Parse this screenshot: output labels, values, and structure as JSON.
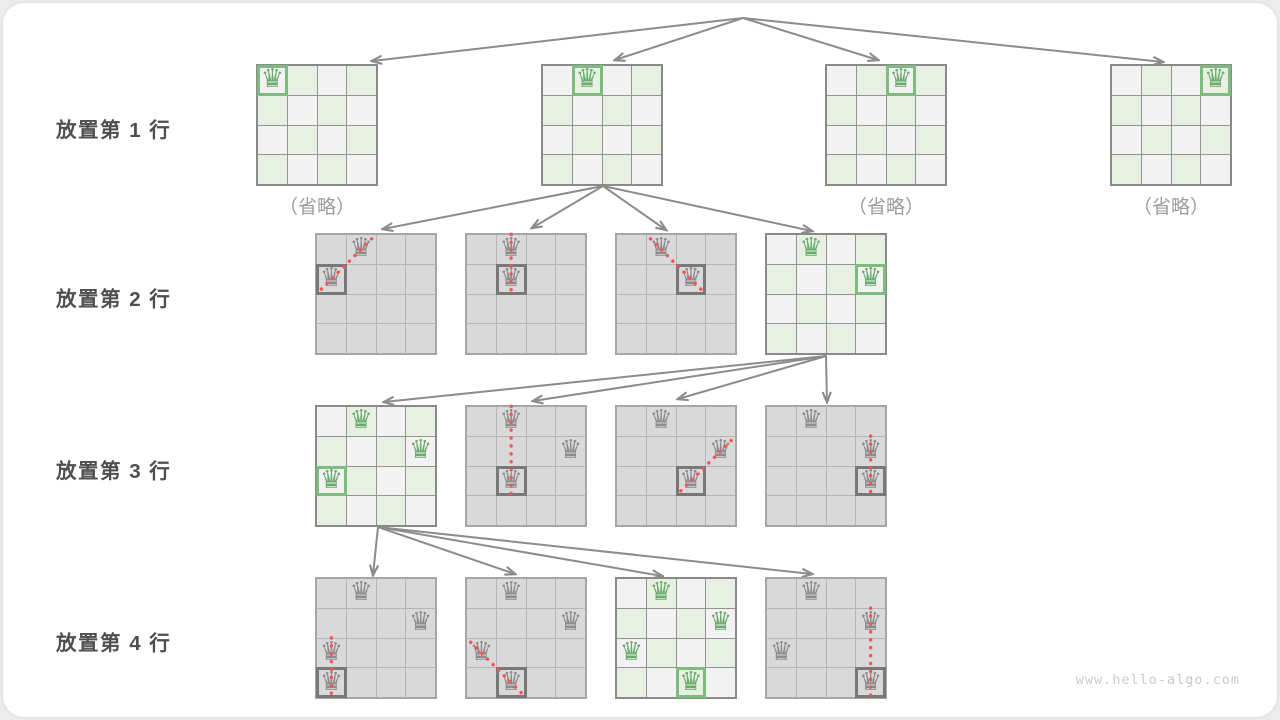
{
  "rows": [
    {
      "label": "放置第 1 行"
    },
    {
      "label": "放置第 2 行"
    },
    {
      "label": "放置第 3 行"
    },
    {
      "label": "放置第 4 行"
    }
  ],
  "captions": {
    "omitted": "（省略）"
  },
  "watermark": {
    "text": "www.hello-algo.com"
  },
  "icons": {
    "queen": "♛"
  },
  "colors": {
    "valid_cell_green": "#e7f0e2",
    "valid_cell_light": "#f2f2f2",
    "invalid_cell_gray": "#d9d9d9",
    "queen_green": "#6cab6e",
    "queen_gray": "#8c8c8c",
    "highlight_green": "#7cbd7f",
    "highlight_dark": "#787878",
    "conflict_red": "#f95353",
    "arrow_gray": "#8c8c8c",
    "label_text": "#4f4f4f",
    "omitted_text": "#9c9c9c",
    "watermark_text": "#cbcbcb"
  },
  "boards": [
    {
      "id": "r1b1",
      "state": "valid",
      "queens": [
        {
          "r": 0,
          "c": 0,
          "new": true
        }
      ],
      "conflict": null,
      "omitted": true
    },
    {
      "id": "r1b2",
      "state": "valid",
      "queens": [
        {
          "r": 0,
          "c": 1,
          "new": true
        }
      ],
      "conflict": null,
      "omitted": false
    },
    {
      "id": "r1b3",
      "state": "valid",
      "queens": [
        {
          "r": 0,
          "c": 2,
          "new": true
        }
      ],
      "conflict": null,
      "omitted": true
    },
    {
      "id": "r1b4",
      "state": "valid",
      "queens": [
        {
          "r": 0,
          "c": 3,
          "new": true
        }
      ],
      "conflict": null,
      "omitted": true
    },
    {
      "id": "r2b1",
      "state": "invalid",
      "queens": [
        {
          "r": 0,
          "c": 1
        },
        {
          "r": 1,
          "c": 0,
          "new": true
        }
      ],
      "conflict": {
        "from": [
          0,
          1
        ],
        "to": [
          1,
          0
        ]
      },
      "omitted": false
    },
    {
      "id": "r2b2",
      "state": "invalid",
      "queens": [
        {
          "r": 0,
          "c": 1
        },
        {
          "r": 1,
          "c": 1,
          "new": true
        }
      ],
      "conflict": {
        "from": [
          0,
          1
        ],
        "to": [
          1,
          1
        ]
      },
      "omitted": false
    },
    {
      "id": "r2b3",
      "state": "invalid",
      "queens": [
        {
          "r": 0,
          "c": 1
        },
        {
          "r": 1,
          "c": 2,
          "new": true
        }
      ],
      "conflict": {
        "from": [
          0,
          1
        ],
        "to": [
          1,
          2
        ]
      },
      "omitted": false
    },
    {
      "id": "r2b4",
      "state": "valid",
      "queens": [
        {
          "r": 0,
          "c": 1
        },
        {
          "r": 1,
          "c": 3,
          "new": true
        }
      ],
      "conflict": null,
      "omitted": false
    },
    {
      "id": "r3b1",
      "state": "valid",
      "queens": [
        {
          "r": 0,
          "c": 1
        },
        {
          "r": 1,
          "c": 3
        },
        {
          "r": 2,
          "c": 0,
          "new": true
        }
      ],
      "conflict": null,
      "omitted": false
    },
    {
      "id": "r3b2",
      "state": "invalid",
      "queens": [
        {
          "r": 0,
          "c": 1
        },
        {
          "r": 1,
          "c": 3
        },
        {
          "r": 2,
          "c": 1,
          "new": true
        }
      ],
      "conflict": {
        "from": [
          0,
          1
        ],
        "to": [
          2,
          1
        ]
      },
      "omitted": false
    },
    {
      "id": "r3b3",
      "state": "invalid",
      "queens": [
        {
          "r": 0,
          "c": 1
        },
        {
          "r": 1,
          "c": 3
        },
        {
          "r": 2,
          "c": 2,
          "new": true
        }
      ],
      "conflict": {
        "from": [
          1,
          3
        ],
        "to": [
          2,
          2
        ]
      },
      "omitted": false
    },
    {
      "id": "r3b4",
      "state": "invalid",
      "queens": [
        {
          "r": 0,
          "c": 1
        },
        {
          "r": 1,
          "c": 3
        },
        {
          "r": 2,
          "c": 3,
          "new": true
        }
      ],
      "conflict": {
        "from": [
          1,
          3
        ],
        "to": [
          2,
          3
        ]
      },
      "omitted": false
    },
    {
      "id": "r4b1",
      "state": "invalid",
      "queens": [
        {
          "r": 0,
          "c": 1
        },
        {
          "r": 1,
          "c": 3
        },
        {
          "r": 2,
          "c": 0
        },
        {
          "r": 3,
          "c": 0,
          "new": true
        }
      ],
      "conflict": {
        "from": [
          2,
          0
        ],
        "to": [
          3,
          0
        ]
      },
      "omitted": false
    },
    {
      "id": "r4b2",
      "state": "invalid",
      "queens": [
        {
          "r": 0,
          "c": 1
        },
        {
          "r": 1,
          "c": 3
        },
        {
          "r": 2,
          "c": 0
        },
        {
          "r": 3,
          "c": 1,
          "new": true
        }
      ],
      "conflict": {
        "from": [
          2,
          0
        ],
        "to": [
          3,
          1
        ]
      },
      "omitted": false
    },
    {
      "id": "r4b3",
      "state": "valid",
      "queens": [
        {
          "r": 0,
          "c": 1
        },
        {
          "r": 1,
          "c": 3
        },
        {
          "r": 2,
          "c": 0
        },
        {
          "r": 3,
          "c": 2,
          "new": true
        }
      ],
      "conflict": null,
      "omitted": false
    },
    {
      "id": "r4b4",
      "state": "invalid",
      "queens": [
        {
          "r": 0,
          "c": 1
        },
        {
          "r": 1,
          "c": 3
        },
        {
          "r": 2,
          "c": 0
        },
        {
          "r": 3,
          "c": 3,
          "new": true
        }
      ],
      "conflict": {
        "from": [
          1,
          3
        ],
        "to": [
          3,
          3
        ]
      },
      "omitted": false
    }
  ],
  "edges": [
    {
      "from": "root",
      "to": "r1b1"
    },
    {
      "from": "root",
      "to": "r1b2"
    },
    {
      "from": "root",
      "to": "r1b3"
    },
    {
      "from": "root",
      "to": "r1b4"
    },
    {
      "from": "r1b2",
      "to": "r2b1"
    },
    {
      "from": "r1b2",
      "to": "r2b2"
    },
    {
      "from": "r1b2",
      "to": "r2b3"
    },
    {
      "from": "r1b2",
      "to": "r2b4"
    },
    {
      "from": "r2b4",
      "to": "r3b1"
    },
    {
      "from": "r2b4",
      "to": "r3b2"
    },
    {
      "from": "r2b4",
      "to": "r3b3"
    },
    {
      "from": "r2b4",
      "to": "r3b4"
    },
    {
      "from": "r3b1",
      "to": "r4b1"
    },
    {
      "from": "r3b1",
      "to": "r4b2"
    },
    {
      "from": "r3b1",
      "to": "r4b3"
    },
    {
      "from": "r3b1",
      "to": "r4b4"
    }
  ]
}
